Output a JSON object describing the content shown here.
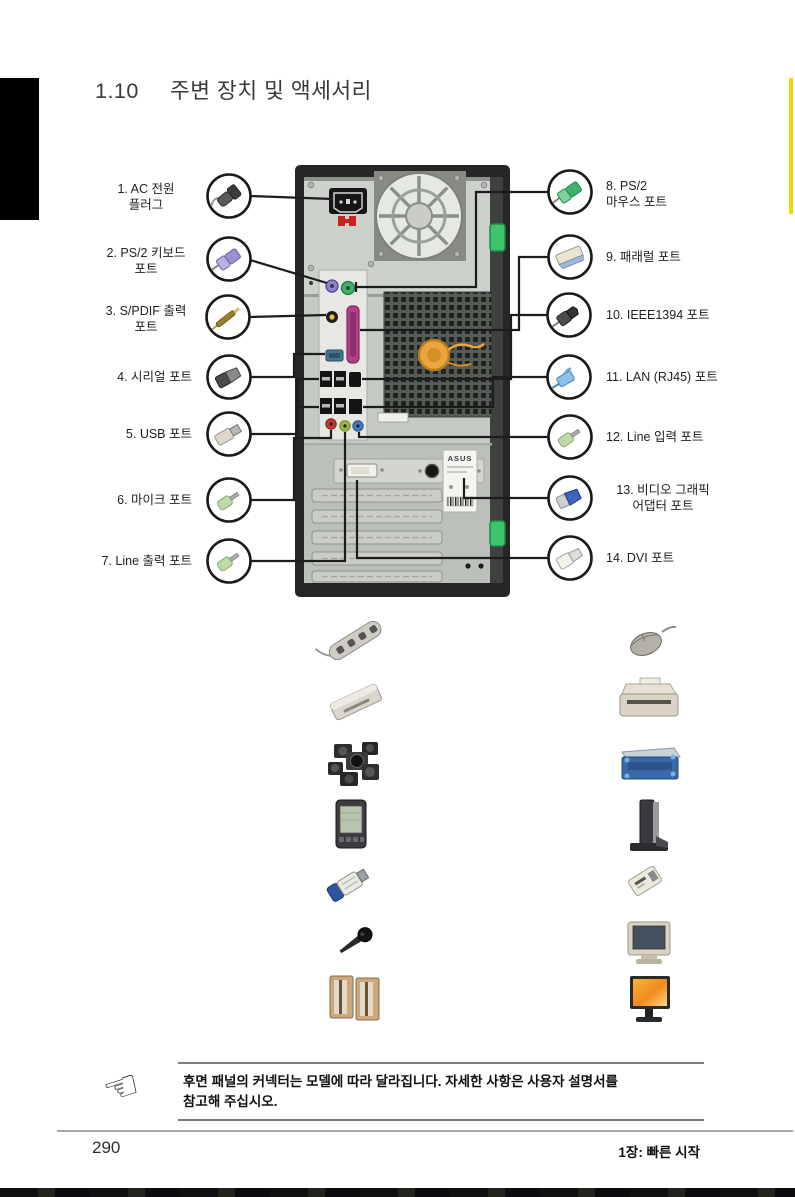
{
  "title": {
    "number": "1.10",
    "text": "주변 장치 및 액세서리"
  },
  "callouts": {
    "left": [
      {
        "num": 1,
        "label": "1. AC 전원\n플러그",
        "icon": "ac-power-plug-icon"
      },
      {
        "num": 2,
        "label": "2. PS/2 키보드\n포트",
        "icon": "ps2-keyboard-plug-icon"
      },
      {
        "num": 3,
        "label": "3. S/PDIF 출력\n포트",
        "icon": "spdif-plug-icon"
      },
      {
        "num": 4,
        "label": "4. 시리얼 포트",
        "icon": "serial-plug-icon"
      },
      {
        "num": 5,
        "label": "5. USB 포트",
        "icon": "usb-plug-icon"
      },
      {
        "num": 6,
        "label": "6. 마이크 포트",
        "icon": "audio-plug-icon"
      },
      {
        "num": 7,
        "label": "7. Line 출력 포트",
        "icon": "audio-plug-icon"
      }
    ],
    "right": [
      {
        "num": 8,
        "label": "8. PS/2\n마우스 포트",
        "icon": "ps2-mouse-plug-icon"
      },
      {
        "num": 9,
        "label": "9. 패래럴 포트",
        "icon": "parallel-plug-icon"
      },
      {
        "num": 10,
        "label": "10. IEEE1394 포트",
        "icon": "ieee1394-plug-icon"
      },
      {
        "num": 11,
        "label": "11. LAN (RJ45) 포트",
        "icon": "rj45-plug-icon"
      },
      {
        "num": 12,
        "label": "12. Line 입력 포트",
        "icon": "audio-plug-icon"
      },
      {
        "num": 13,
        "label": "13. 비디오 그래픽\n어댑터 포트",
        "icon": "vga-plug-icon"
      },
      {
        "num": 14,
        "label": "14. DVI 포트",
        "icon": "dvi-plug-icon"
      }
    ]
  },
  "tower": {
    "brand_sticker": "ASUS"
  },
  "accessories": {
    "left": [
      "power-strip",
      "card-reader",
      "surround-speaker-set",
      "pda",
      "usb-flash-drive",
      "microphone",
      "stereo-speakers"
    ],
    "right": [
      "mouse",
      "printer",
      "external-drive",
      "docking-stand",
      "usb-adapter",
      "crt-monitor",
      "lcd-monitor"
    ]
  },
  "note": {
    "text": "후면 패널의 커넥터는 모델에 따라 달라집니다. 자세한 사항은 사용자 설명서를\n참고해 주십시오."
  },
  "footer": {
    "page_number": "290",
    "chapter_label": "1장: 빠른 시작"
  },
  "icons": {
    "note_hand": "☞"
  },
  "colors": {
    "ps2_keyboard_purple": "#8d84cc",
    "ps2_mouse_green": "#43b06a",
    "parallel_port_magenta": "#b53f8b",
    "mic_jack_red": "#c23737",
    "line_out_jack_lime": "#9cb93f",
    "line_in_jack_blue": "#3f7fc1",
    "spdif_rca_yellow": "#e4c43f",
    "fan_hub_orange": "#eaa53e",
    "chassis_clip_green": "#3ec46d",
    "side_tab_yellow": "#f2d800",
    "vga_blue": "#3a66c4"
  }
}
